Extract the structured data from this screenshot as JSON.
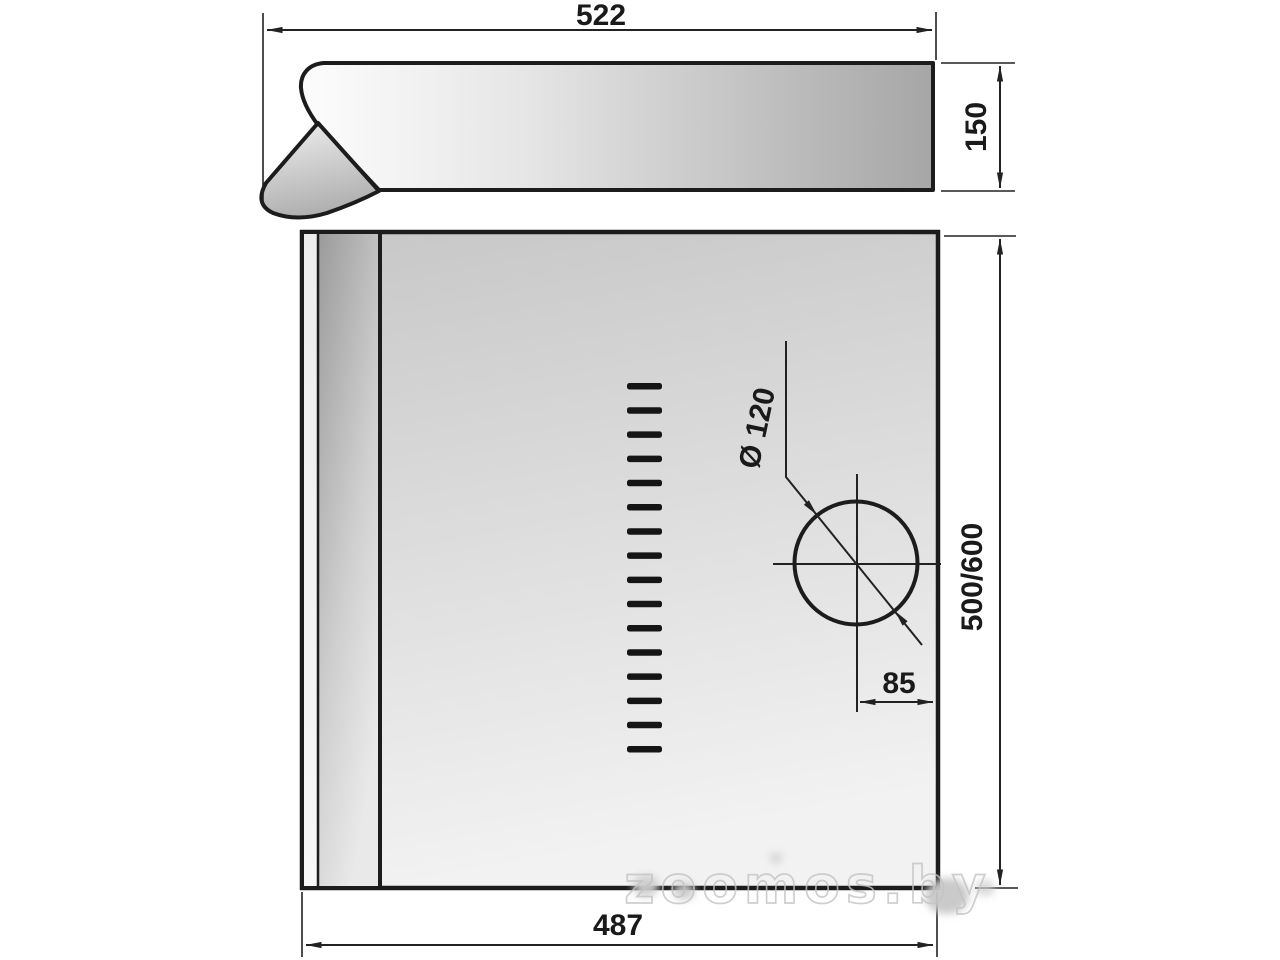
{
  "drawing": {
    "type": "cooker-hood-installation-drawing",
    "dimensions": {
      "top_width": "522",
      "top_depth": "150",
      "front_height": "500/600",
      "front_width": "487",
      "duct_offset": "85",
      "duct_diameter": "Ø 120"
    },
    "vent_slots": {
      "count": 16
    },
    "watermark": "zoomos.by",
    "colors": {
      "line": "#1c1c1c",
      "dim_line": "#222222",
      "watermark": "#c3c3c3"
    }
  }
}
